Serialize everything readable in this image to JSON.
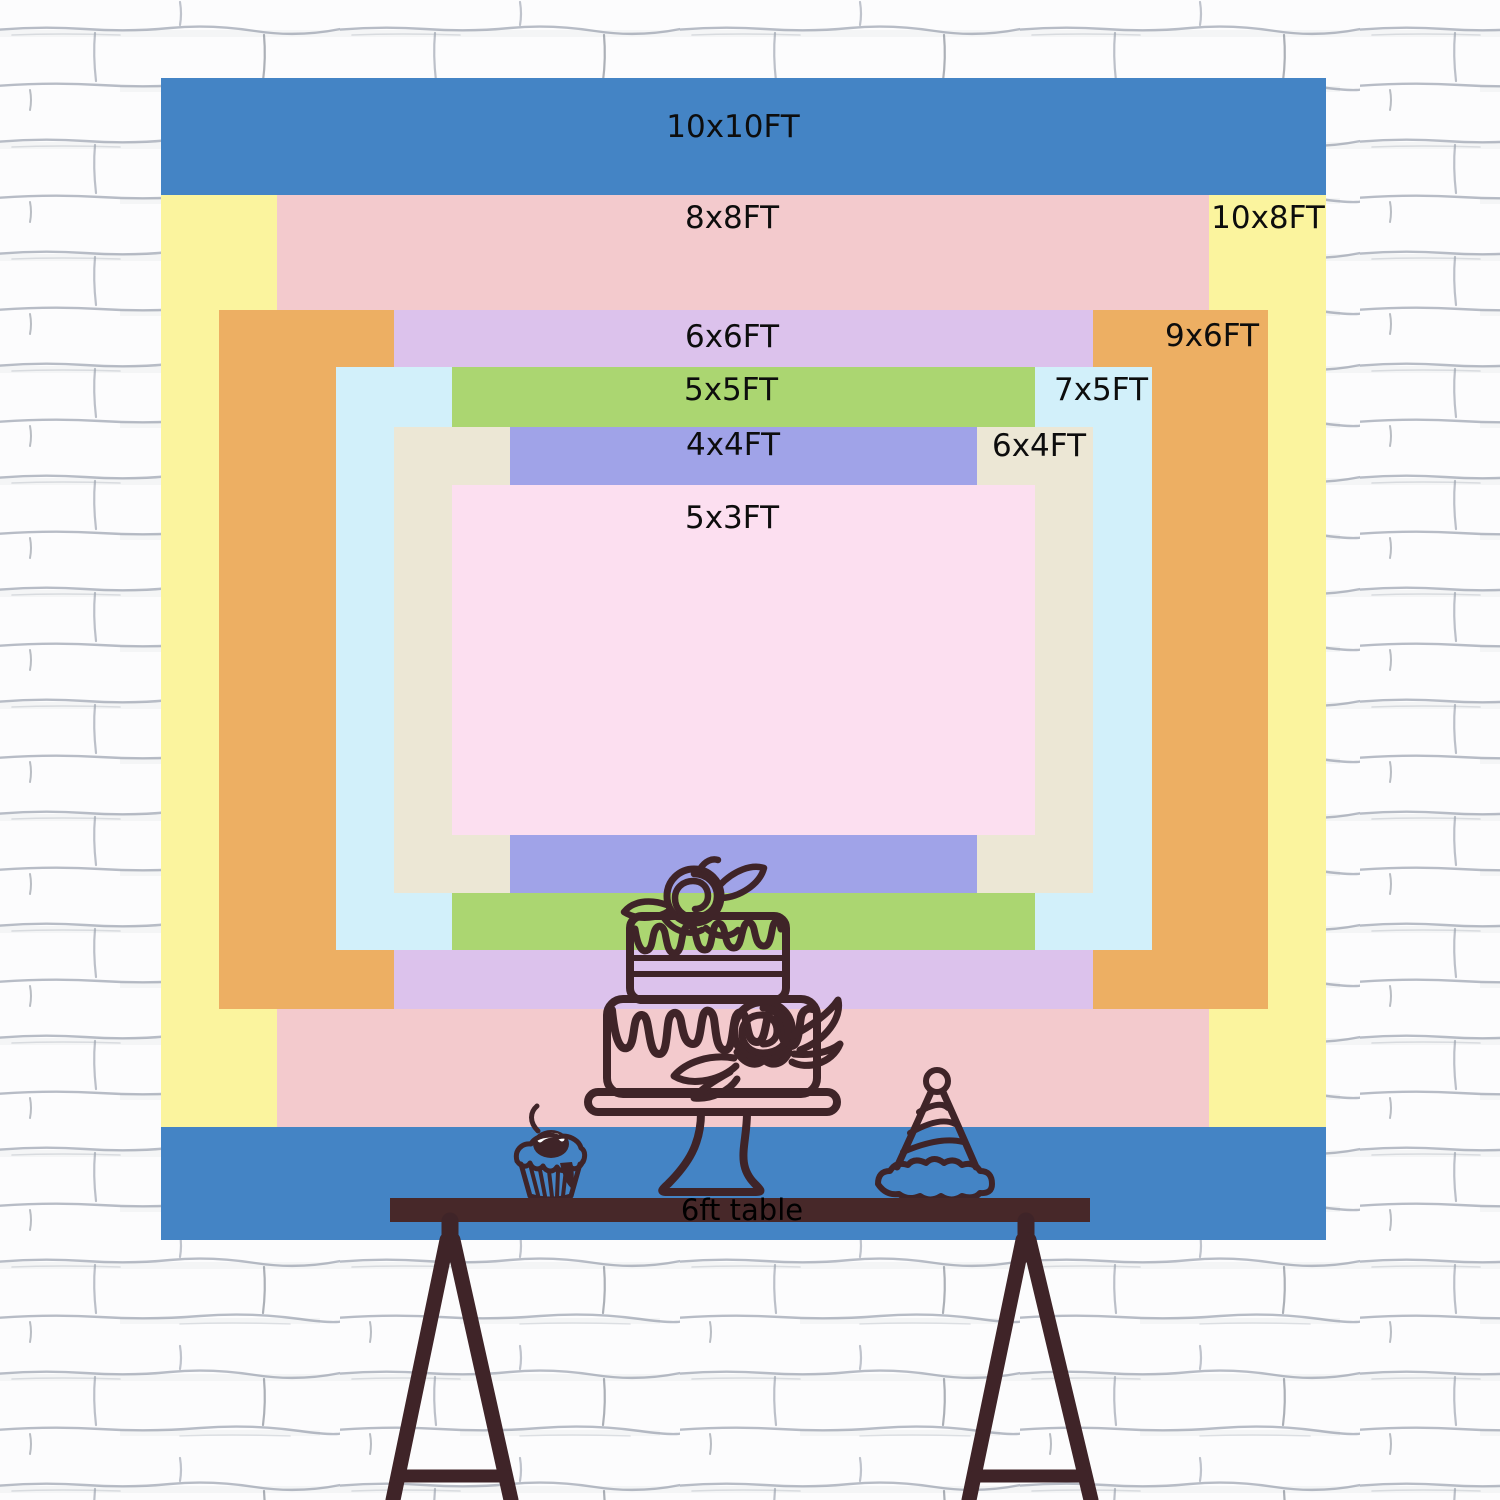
{
  "colors": {
    "ink": "#3f2428",
    "table": "#472829",
    "wallbg": "#fcfcfd",
    "mortar": "#a6acb8"
  },
  "chart": {
    "layers": [
      {
        "id": "10x10",
        "label": "10x10FT",
        "color": "#4484C5",
        "width_ft": 10,
        "height_ft": 10
      },
      {
        "id": "10x8",
        "label": "10x8FT",
        "color": "#FBF49E",
        "width_ft": 10,
        "height_ft": 8
      },
      {
        "id": "8x8",
        "label": "8x8FT",
        "color": "#F3CACD",
        "width_ft": 8,
        "height_ft": 8
      },
      {
        "id": "9x6",
        "label": "9x6FT",
        "color": "#EDAF63",
        "width_ft": 9,
        "height_ft": 6
      },
      {
        "id": "6x6",
        "label": "6x6FT",
        "color": "#DCC2EC",
        "width_ft": 6,
        "height_ft": 6
      },
      {
        "id": "7x5",
        "label": "7x5FT",
        "color": "#D2F0FA",
        "width_ft": 7,
        "height_ft": 5
      },
      {
        "id": "5x5",
        "label": "5x5FT",
        "color": "#ABD671",
        "width_ft": 5,
        "height_ft": 5
      },
      {
        "id": "6x4",
        "label": "6x4FT",
        "color": "#ECE7D5",
        "width_ft": 6,
        "height_ft": 4
      },
      {
        "id": "4x4",
        "label": "4x4FT",
        "color": "#A0A3E8",
        "width_ft": 4,
        "height_ft": 4
      },
      {
        "id": "5x3",
        "label": "5x3FT",
        "color": "#FCDFF0",
        "width_ft": 5,
        "height_ft": 3
      }
    ],
    "table": {
      "label": "6ft table",
      "length_ft": 6
    }
  }
}
